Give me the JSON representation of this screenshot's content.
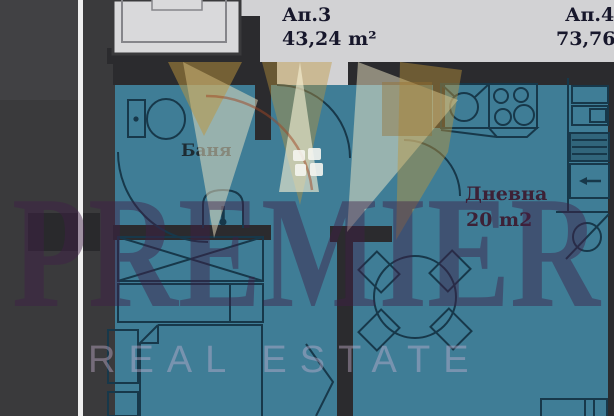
{
  "header": {
    "apartments": [
      {
        "name": "Ап.3",
        "area": "43,24 m²"
      },
      {
        "name": "Ап.4",
        "area": "73,76 m²"
      }
    ]
  },
  "rooms": {
    "bathroom": {
      "label": "Баня"
    },
    "living": {
      "label": "Дневна",
      "area": "20 m2"
    }
  },
  "watermark": {
    "brand": "PREMIER",
    "tagline": "REAL ESTATE"
  },
  "colors": {
    "interior_teal": "#3f7d96",
    "wall_dark": "#2b2b2e",
    "plan_line": "#17384a",
    "neighbor_gray": "#d2d2d4",
    "crown_gold": "#be9640",
    "brand_purple": "#40264a",
    "tagline_lavender": "#c8b2d2"
  }
}
